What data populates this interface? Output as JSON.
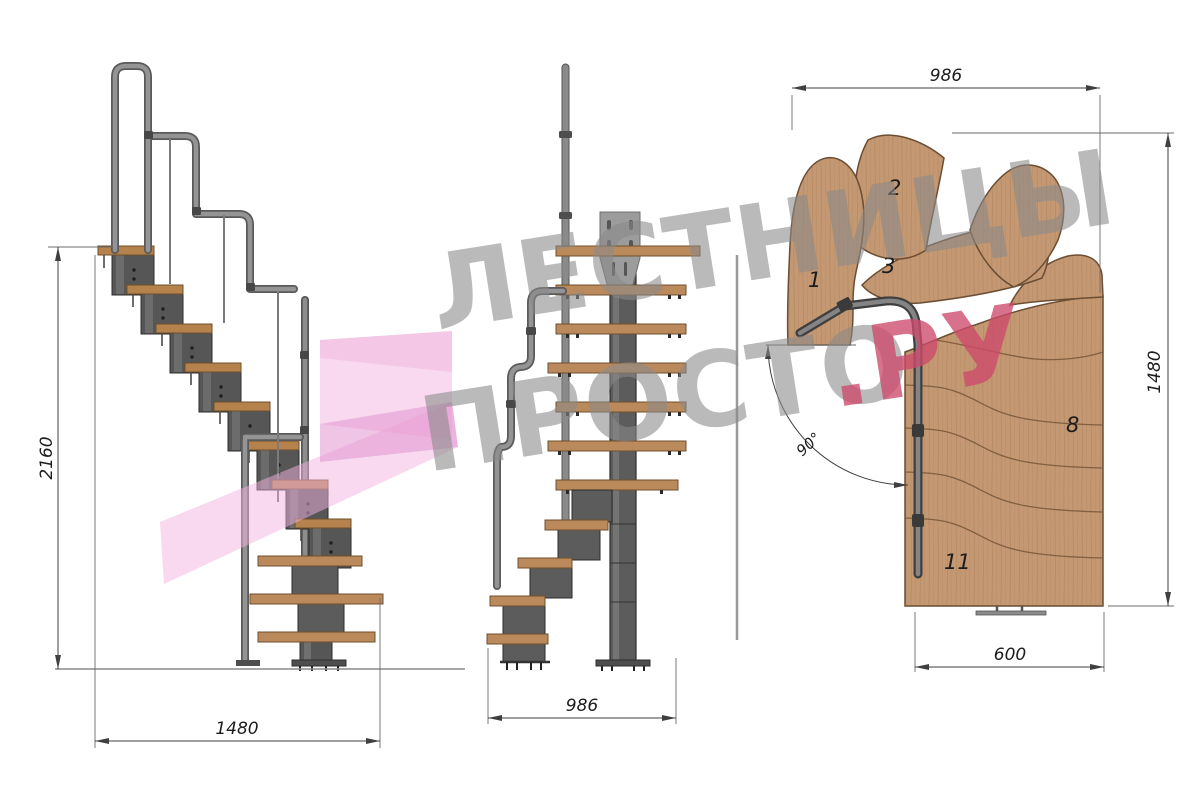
{
  "watermark": {
    "line1": "ЛЕСТНИЦЫ",
    "line2": "ПРОСТО",
    "line2_accent": ".РУ",
    "gray_color": "#8a8a8a",
    "accent_color": "#ce4a6b"
  },
  "views": {
    "side": {
      "label": "side elevation",
      "dims": {
        "height": "2160",
        "run": "1480"
      }
    },
    "front": {
      "label": "front elevation",
      "dims": {
        "width": "986"
      }
    },
    "plan": {
      "label": "top plan",
      "dims": {
        "width_top": "986",
        "height_right": "1480",
        "bottom_width": "600",
        "turn_angle": "90°"
      },
      "step_labels": {
        "s1": "1",
        "s2": "2",
        "s3": "3",
        "s8": "8",
        "s11": "11"
      }
    }
  },
  "colors": {
    "wood_plan": "#c49872",
    "wood_tread": "#b5824e",
    "wood_edge": "#7a5a3d",
    "metal_module": "#565656",
    "rail_pipe": "#8d8d8d",
    "dimension_line": "#3f3f3f",
    "logo_pink": "#f2b4e0",
    "logo_pink_dark": "#e193cf"
  }
}
